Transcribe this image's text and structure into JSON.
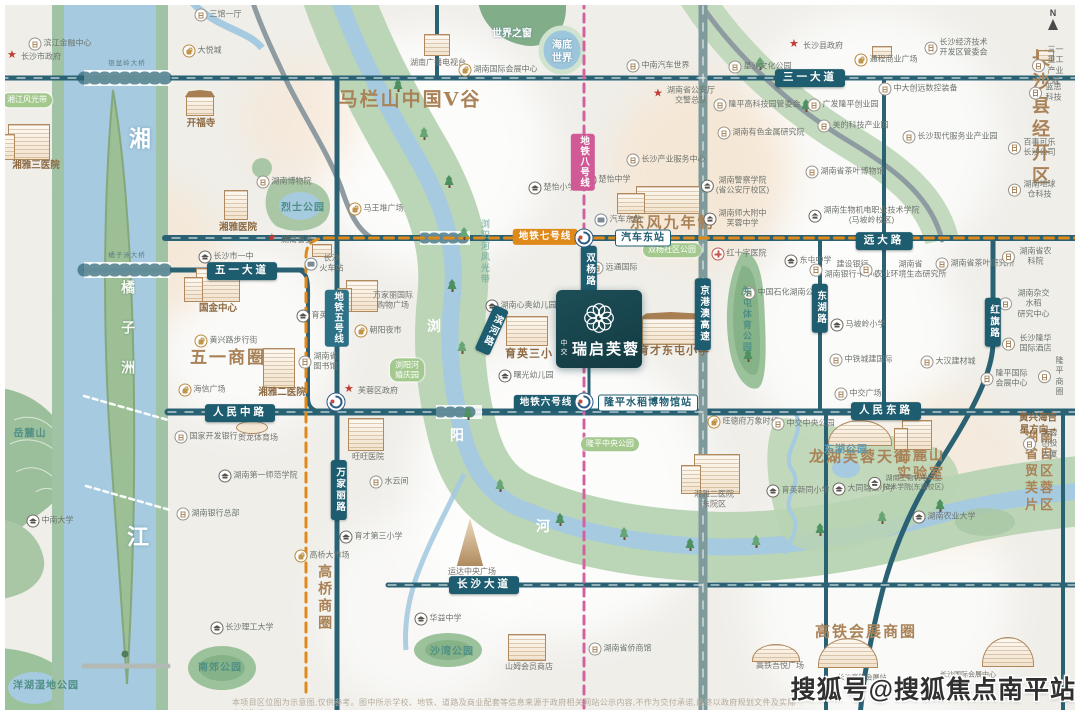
{
  "project": {
    "brand": "中交",
    "name": "瑞启芙蓉"
  },
  "watermark": "搜狐号@搜狐焦点南平站",
  "disclaimer": "本项目区位图为示意图,仅供参考。图中所示学校、地铁、道路及商业配套等信息来源于政府相关网站公示内容,不作为交付承诺,最终以政府规划文件及实际交付为准。",
  "compass": {
    "n": "N"
  },
  "colors": {
    "brand_teal": "#16424b",
    "road_teal": "#235e70",
    "metro7": "#e0891b",
    "metro8": "#cf5a96",
    "metro5": "#2d7186",
    "river_blue": "#a6cadf",
    "park_green": "#b7d3b3",
    "poi_brown": "#8d6a44",
    "zone_brown": "#aa8257"
  },
  "labels": [
    {
      "t": "滨江金融中心",
      "x": 60,
      "y": 44,
      "c": "poi",
      "i": "b"
    },
    {
      "t": "长沙市政府",
      "x": 34,
      "y": 57,
      "c": "poi",
      "i": "st"
    },
    {
      "t": "三馆一厅",
      "x": 218,
      "y": 15,
      "c": "poi",
      "i": "b"
    },
    {
      "t": "大悦城",
      "x": 202,
      "y": 51,
      "c": "poi",
      "i": "sh"
    },
    {
      "t": "湘江风光带",
      "x": 27,
      "y": 100,
      "c": "gpill"
    },
    {
      "t": "开福寺",
      "x": 201,
      "y": 124,
      "c": "brown-s"
    },
    {
      "t": "湘雅三医院",
      "x": 36,
      "y": 166,
      "c": "brown-s"
    },
    {
      "t": "湘",
      "x": 140,
      "y": 140,
      "c": "water22"
    },
    {
      "t": "江",
      "x": 138,
      "y": 538,
      "c": "water22"
    },
    {
      "t": "橘子洲",
      "x": 127,
      "y": 340,
      "c": "island"
    },
    {
      "t": "银盆岭大桥",
      "x": 127,
      "y": 64,
      "c": "bridge"
    },
    {
      "t": "橘子洲大桥",
      "x": 127,
      "y": 256,
      "c": "bridge"
    },
    {
      "t": "湖南博物院",
      "x": 284,
      "y": 182,
      "c": "poi",
      "i": "b"
    },
    {
      "t": "烈士公园",
      "x": 303,
      "y": 208,
      "c": "park"
    },
    {
      "t": "湖南省委",
      "x": 290,
      "y": 240,
      "c": "poi",
      "i": "st"
    },
    {
      "t": "湘雅医院",
      "x": 238,
      "y": 228,
      "c": "brown-s"
    },
    {
      "t": "马王堆广场",
      "x": 376,
      "y": 209,
      "c": "poi",
      "i": "sh"
    },
    {
      "t": "马栏山中国V谷",
      "x": 410,
      "y": 100,
      "c": "zone z19"
    },
    {
      "t": "湖南广播电视台",
      "x": 438,
      "y": 63,
      "c": "cap"
    },
    {
      "t": "湖南国际会展中心",
      "x": 498,
      "y": 70,
      "c": "poi",
      "i": "sh"
    },
    {
      "t": "世界之窗",
      "x": 512,
      "y": 34,
      "c": "white-s"
    },
    {
      "t": "海底\n世界",
      "x": 562,
      "y": 52,
      "c": "white-s"
    },
    {
      "t": "中南汽车世界",
      "x": 658,
      "y": 66,
      "c": "poi",
      "i": "b"
    },
    {
      "t": "湖南省公安厅\n交警总队",
      "x": 684,
      "y": 96,
      "c": "poi",
      "i": "st"
    },
    {
      "t": "长沙县政府",
      "x": 816,
      "y": 46,
      "c": "poi",
      "i": "st"
    },
    {
      "t": "通程商业广场",
      "x": 886,
      "y": 60,
      "c": "poi",
      "i": "sh"
    },
    {
      "t": "星沙文化公园",
      "x": 760,
      "y": 67,
      "c": "poi",
      "i": "b"
    },
    {
      "t": "长沙经济技术\n开发区管委会",
      "x": 956,
      "y": 48,
      "c": "poi",
      "i": "b"
    },
    {
      "t": "三一重工\n产业城",
      "x": 1048,
      "y": 66,
      "c": "poi",
      "i": "b"
    },
    {
      "t": "三一大道",
      "x": 810,
      "y": 78,
      "c": "rpill"
    },
    {
      "t": "地铁八号线",
      "x": 583,
      "y": 162,
      "c": "m8 vpill"
    },
    {
      "t": "楚怡小学",
      "x": 552,
      "y": 188,
      "c": "poi",
      "i": "s"
    },
    {
      "t": "楚怡中学",
      "x": 607,
      "y": 180,
      "c": "poi",
      "i": "s"
    },
    {
      "t": "长沙产业服务中心",
      "x": 666,
      "y": 160,
      "c": "poi",
      "i": "b"
    },
    {
      "t": "东风九年制",
      "x": 672,
      "y": 223,
      "c": "zone z15"
    },
    {
      "t": "汽车东站",
      "x": 618,
      "y": 220,
      "c": "poi",
      "i": "bus"
    },
    {
      "t": "湖南警察学院\n(省公安厅校区)",
      "x": 735,
      "y": 186,
      "c": "poi",
      "i": "s"
    },
    {
      "t": "湖南师大附中\n芙蓉中学",
      "x": 735,
      "y": 219,
      "c": "poi",
      "i": "s"
    },
    {
      "t": "隆平高科技园管委会",
      "x": 757,
      "y": 105,
      "c": "poi",
      "i": "b"
    },
    {
      "t": "广发隆平创业园",
      "x": 843,
      "y": 105,
      "c": "poi",
      "i": "b"
    },
    {
      "t": "美的科技产业园",
      "x": 853,
      "y": 126,
      "c": "poi",
      "i": "b"
    },
    {
      "t": "湖南有色金属研究院",
      "x": 761,
      "y": 133,
      "c": "poi",
      "i": "b"
    },
    {
      "t": "长沙现代服务业产业园",
      "x": 950,
      "y": 137,
      "c": "poi",
      "i": "b"
    },
    {
      "t": "湖南省茶叶博物馆",
      "x": 845,
      "y": 172,
      "c": "poi",
      "i": "b"
    },
    {
      "t": "湖南生物机电职业技术学院\n(马坡岭校区)",
      "x": 864,
      "y": 216,
      "c": "poi",
      "i": "s"
    },
    {
      "t": "中大创远数控装备",
      "x": 918,
      "y": 89,
      "c": "poi",
      "i": "b"
    },
    {
      "t": "长沙县经开区",
      "x": 1042,
      "y": 118,
      "c": "zone z18"
    },
    {
      "t": "蓝思科技",
      "x": 1046,
      "y": 93,
      "c": "poi",
      "i": "b"
    },
    {
      "t": "百事可乐长沙公司",
      "x": 1032,
      "y": 148,
      "c": "poi",
      "i": "b"
    },
    {
      "t": "湖南地球仓科技",
      "x": 1032,
      "y": 190,
      "c": "poi",
      "i": "b"
    },
    {
      "t": "地铁七号线",
      "x": 545,
      "y": 237,
      "c": "m7"
    },
    {
      "t": "汽车东站",
      "x": 643,
      "y": 238,
      "c": "spill"
    },
    {
      "t": "远大路",
      "x": 884,
      "y": 241,
      "c": "rpill"
    },
    {
      "t": "红十字医院",
      "x": 739,
      "y": 254,
      "c": "poi",
      "i": "h"
    },
    {
      "t": "东屯中学",
      "x": 808,
      "y": 261,
      "c": "poi",
      "i": "s"
    },
    {
      "t": "双杨社区公园",
      "x": 672,
      "y": 250,
      "c": "gpill"
    },
    {
      "t": "双杨路",
      "x": 589,
      "y": 270,
      "c": "rpill vpill"
    },
    {
      "t": "远通国际",
      "x": 614,
      "y": 268,
      "c": "poi",
      "i": "b"
    },
    {
      "t": "中国石化湖南公司",
      "x": 782,
      "y": 293,
      "c": "poi",
      "i": "b"
    },
    {
      "t": "东湖路",
      "x": 820,
      "y": 308,
      "c": "rpill vpill"
    },
    {
      "t": "京港澳高速",
      "x": 703,
      "y": 314,
      "c": "rpill vpill"
    },
    {
      "t": "红旗路",
      "x": 993,
      "y": 322,
      "c": "rpill vpill"
    },
    {
      "t": "马坡岭小学",
      "x": 858,
      "y": 325,
      "c": "poi",
      "i": "s"
    },
    {
      "t": "建设银行\n湖南银行卡中心",
      "x": 845,
      "y": 270,
      "c": "poi",
      "i": "b"
    },
    {
      "t": "湖南省\n农业环境生态研究所",
      "x": 903,
      "y": 270,
      "c": "poi",
      "i": "b"
    },
    {
      "t": "湖南省茶叶研究所",
      "x": 975,
      "y": 264,
      "c": "poi",
      "i": "b"
    },
    {
      "t": "湖南省农科院",
      "x": 1028,
      "y": 257,
      "c": "poi",
      "i": "b"
    },
    {
      "t": "湖南杂交水稻\n研究中心",
      "x": 1026,
      "y": 304,
      "c": "poi",
      "i": "b"
    },
    {
      "t": "长沙隆华国际酒店",
      "x": 1028,
      "y": 344,
      "c": "poi",
      "i": "b"
    },
    {
      "t": "中铁城建国际",
      "x": 861,
      "y": 360,
      "c": "poi",
      "i": "b"
    },
    {
      "t": "大汉建材城",
      "x": 948,
      "y": 362,
      "c": "poi",
      "i": "b"
    },
    {
      "t": "中交广场",
      "x": 858,
      "y": 394,
      "c": "poi",
      "i": "b"
    },
    {
      "t": "隆平国际\n会展中心",
      "x": 1004,
      "y": 379,
      "c": "poi",
      "i": "b"
    },
    {
      "t": "隆平商圈",
      "x": 1052,
      "y": 377,
      "c": "poi",
      "i": "b"
    },
    {
      "t": "东屯体育公园",
      "x": 746,
      "y": 320,
      "c": "park-v"
    },
    {
      "t": "人民东路",
      "x": 886,
      "y": 411,
      "c": "rpill"
    },
    {
      "t": "人民中路",
      "x": 240,
      "y": 413,
      "c": "rpill"
    },
    {
      "t": "五一大道",
      "x": 242,
      "y": 271,
      "c": "rpill"
    },
    {
      "t": "长沙市一中",
      "x": 226,
      "y": 257,
      "c": "poi",
      "i": "s"
    },
    {
      "t": "国金中心",
      "x": 218,
      "y": 309,
      "c": "brown-s"
    },
    {
      "t": "黄兴路步行街",
      "x": 226,
      "y": 341,
      "c": "poi",
      "i": "sh"
    },
    {
      "t": "五一商圈",
      "x": 228,
      "y": 358,
      "c": "zone z17"
    },
    {
      "t": "海信广场",
      "x": 202,
      "y": 390,
      "c": "poi",
      "i": "sh"
    },
    {
      "t": "湘雅二医院",
      "x": 282,
      "y": 393,
      "c": "brown-s"
    },
    {
      "t": "育英学校",
      "x": 320,
      "y": 316,
      "c": "poi",
      "i": "s"
    },
    {
      "t": "湖南省\n图书馆",
      "x": 318,
      "y": 362,
      "c": "poi",
      "i": "b"
    },
    {
      "t": "长沙\n火车站",
      "x": 324,
      "y": 264,
      "c": "poi",
      "i": "tr"
    },
    {
      "t": "地铁五号线",
      "x": 337,
      "y": 318,
      "c": "m5 vpill"
    },
    {
      "t": "万家丽国际\n购物广场",
      "x": 393,
      "y": 301,
      "c": "cap"
    },
    {
      "t": "朝阳夜市",
      "x": 378,
      "y": 331,
      "c": "poi",
      "i": "sh"
    },
    {
      "t": "湖南心奥幼儿园",
      "x": 521,
      "y": 306,
      "c": "poi",
      "i": "s"
    },
    {
      "t": "曙光幼儿园",
      "x": 526,
      "y": 376,
      "c": "poi",
      "i": "s"
    },
    {
      "t": "育英三小",
      "x": 529,
      "y": 354,
      "c": "brown"
    },
    {
      "t": "育才东屯小学",
      "x": 674,
      "y": 351,
      "c": "brown"
    },
    {
      "t": "滨河路",
      "x": 492,
      "y": 330,
      "c": "rpill vpill tilt"
    },
    {
      "t": "浏阳河风光带",
      "x": 484,
      "y": 252,
      "c": "park-v dim"
    },
    {
      "t": "浏",
      "x": 434,
      "y": 327,
      "c": "water15"
    },
    {
      "t": "阳",
      "x": 457,
      "y": 436,
      "c": "water15"
    },
    {
      "t": "河",
      "x": 543,
      "y": 527,
      "c": "water15"
    },
    {
      "t": "地铁六号线",
      "x": 546,
      "y": 403,
      "c": "m6"
    },
    {
      "t": "隆平水稻博物馆站",
      "x": 648,
      "y": 403,
      "c": "spill"
    },
    {
      "t": "浏阳河\n婚庆园",
      "x": 407,
      "y": 370,
      "c": "gpill"
    },
    {
      "t": "芙蓉区政府",
      "x": 371,
      "y": 391,
      "c": "poi",
      "i": "st"
    },
    {
      "t": "旺德府万象时代",
      "x": 743,
      "y": 422,
      "c": "poi",
      "i": "sh"
    },
    {
      "t": "中交中央公园",
      "x": 803,
      "y": 424,
      "c": "poi",
      "i": "b"
    },
    {
      "t": "隆平中央公园",
      "x": 610,
      "y": 444,
      "c": "gpill"
    },
    {
      "t": "旺旺医院",
      "x": 368,
      "y": 457,
      "c": "cap"
    },
    {
      "t": "水云间",
      "x": 389,
      "y": 482,
      "c": "poi",
      "i": "b"
    },
    {
      "t": "育才第三小学",
      "x": 371,
      "y": 537,
      "c": "poi",
      "i": "s"
    },
    {
      "t": "万家丽路",
      "x": 339,
      "y": 490,
      "c": "rpill vpill"
    },
    {
      "t": "国家开发银行",
      "x": 206,
      "y": 437,
      "c": "poi",
      "i": "b"
    },
    {
      "t": "贺龙体育场",
      "x": 258,
      "y": 438,
      "c": "cap"
    },
    {
      "t": "湖南第一师范学院",
      "x": 258,
      "y": 476,
      "c": "poi",
      "i": "s"
    },
    {
      "t": "湖南银行总部",
      "x": 208,
      "y": 514,
      "c": "poi",
      "i": "b"
    },
    {
      "t": "岳麓山",
      "x": 30,
      "y": 434,
      "c": "park p12"
    },
    {
      "t": "中南大学",
      "x": 50,
      "y": 521,
      "c": "poi",
      "i": "s"
    },
    {
      "t": "长沙理工大学",
      "x": 242,
      "y": 628,
      "c": "poi",
      "i": "s"
    },
    {
      "t": "南郊公园",
      "x": 220,
      "y": 668,
      "c": "park"
    },
    {
      "t": "洋湖湿地公园",
      "x": 46,
      "y": 686,
      "c": "park"
    },
    {
      "t": "高桥大市场",
      "x": 322,
      "y": 556,
      "c": "poi",
      "i": "sh"
    },
    {
      "t": "高桥商圈",
      "x": 324,
      "y": 598,
      "c": "zone z14 zv"
    },
    {
      "t": "华益中学",
      "x": 438,
      "y": 619,
      "c": "poi",
      "i": "s"
    },
    {
      "t": "沙湾公园",
      "x": 452,
      "y": 652,
      "c": "park"
    },
    {
      "t": "运达中央广场",
      "x": 472,
      "y": 572,
      "c": "cap"
    },
    {
      "t": "山姆会员商店",
      "x": 529,
      "y": 667,
      "c": "cap"
    },
    {
      "t": "长沙大道",
      "x": 484,
      "y": 585,
      "c": "rpill"
    },
    {
      "t": "湖南省侨商馆",
      "x": 620,
      "y": 649,
      "c": "poi",
      "i": "b"
    },
    {
      "t": "湘雅二医院\n东院区",
      "x": 714,
      "y": 500,
      "c": "cap"
    },
    {
      "t": "东湖公园",
      "x": 846,
      "y": 450,
      "c": "park pb"
    },
    {
      "t": "龙湖芙蓉天街",
      "x": 860,
      "y": 457,
      "c": "zone z15"
    },
    {
      "t": "岳麓山\n实验室",
      "x": 921,
      "y": 465,
      "c": "zone z14"
    },
    {
      "t": "大同瑞致小学",
      "x": 864,
      "y": 489,
      "c": "poi",
      "i": "s"
    },
    {
      "t": "育英新同小学",
      "x": 798,
      "y": 491,
      "c": "poi",
      "i": "s"
    },
    {
      "t": "湖南生物机电职业\n技术学院(东湖校区)",
      "x": 906,
      "y": 483,
      "c": "poi p7",
      "i": "s"
    },
    {
      "t": "湖南农业大学",
      "x": 944,
      "y": 517,
      "c": "poi",
      "i": "s"
    },
    {
      "t": "湖南省自贸区\n芙蓉片区",
      "x": 1040,
      "y": 472,
      "c": "zone z13"
    },
    {
      "t": "芙蓉创投大厦",
      "x": 1042,
      "y": 444,
      "c": "poi",
      "i": "b"
    },
    {
      "t": "黄兴海吉星方向→",
      "x": 1038,
      "y": 425,
      "c": "brown-s p9"
    },
    {
      "t": "高铁会展商圈",
      "x": 866,
      "y": 632,
      "c": "zone z15"
    },
    {
      "t": "高铁吾悦广场",
      "x": 780,
      "y": 666,
      "c": "cap"
    },
    {
      "t": "长沙高铁会展站",
      "x": 862,
      "y": 678,
      "c": "cap p7"
    },
    {
      "t": "长沙国际会展中心",
      "x": 968,
      "y": 675,
      "c": "cap p7"
    },
    {
      "c": "mlogo",
      "x": 584,
      "y": 238
    },
    {
      "c": "mlogo",
      "x": 584,
      "y": 402
    },
    {
      "c": "mlogo",
      "x": 336,
      "y": 402
    }
  ],
  "buildings": [
    {
      "x": 196,
      "y": 268,
      "w": 44,
      "h": 34,
      "k": "towers"
    },
    {
      "x": 8,
      "y": 124,
      "w": 42,
      "h": 36,
      "k": "towers"
    },
    {
      "x": 186,
      "y": 96,
      "w": 28,
      "h": 20,
      "k": "temple"
    },
    {
      "x": 424,
      "y": 34,
      "w": 26,
      "h": 22,
      "k": "block"
    },
    {
      "x": 224,
      "y": 190,
      "w": 24,
      "h": 30,
      "k": "tower"
    },
    {
      "x": 346,
      "y": 280,
      "w": 32,
      "h": 32,
      "k": "towers"
    },
    {
      "x": 263,
      "y": 348,
      "w": 32,
      "h": 40,
      "k": "tower"
    },
    {
      "x": 506,
      "y": 316,
      "w": 42,
      "h": 30,
      "k": "block"
    },
    {
      "x": 642,
      "y": 318,
      "w": 58,
      "h": 27,
      "k": "temple"
    },
    {
      "x": 636,
      "y": 186,
      "w": 64,
      "h": 28,
      "k": "towers"
    },
    {
      "x": 872,
      "y": 46,
      "w": 20,
      "h": 12,
      "k": "block"
    },
    {
      "x": 348,
      "y": 418,
      "w": 36,
      "h": 33,
      "k": "tower"
    },
    {
      "x": 448,
      "y": 518,
      "w": 44,
      "h": 48,
      "k": "spire"
    },
    {
      "x": 508,
      "y": 634,
      "w": 38,
      "h": 27,
      "k": "block"
    },
    {
      "x": 828,
      "y": 420,
      "w": 64,
      "h": 26,
      "k": "arc"
    },
    {
      "x": 902,
      "y": 420,
      "w": 30,
      "h": 30,
      "k": "towers"
    },
    {
      "x": 694,
      "y": 454,
      "w": 46,
      "h": 40,
      "k": "towers"
    },
    {
      "x": 752,
      "y": 644,
      "w": 48,
      "h": 18,
      "k": "arc"
    },
    {
      "x": 818,
      "y": 638,
      "w": 60,
      "h": 30,
      "k": "arc"
    },
    {
      "x": 982,
      "y": 637,
      "w": 52,
      "h": 30,
      "k": "arc"
    },
    {
      "x": 236,
      "y": 421,
      "w": 32,
      "h": 13,
      "k": "stadium"
    },
    {
      "x": 312,
      "y": 244,
      "w": 20,
      "h": 13,
      "k": "block"
    },
    {
      "x": 1038,
      "y": 50,
      "w": 16,
      "h": 11,
      "k": "block"
    }
  ],
  "trees": [
    [
      398,
      92
    ],
    [
      424,
      140
    ],
    [
      449,
      188
    ],
    [
      464,
      240
    ],
    [
      452,
      292
    ],
    [
      462,
      354
    ],
    [
      468,
      420
    ],
    [
      500,
      492
    ],
    [
      560,
      526
    ],
    [
      624,
      540
    ],
    [
      690,
      551
    ],
    [
      756,
      548
    ],
    [
      820,
      536
    ],
    [
      882,
      524
    ],
    [
      940,
      512
    ],
    [
      745,
      298
    ],
    [
      748,
      362
    ],
    [
      760,
      70
    ],
    [
      806,
      112
    ]
  ]
}
